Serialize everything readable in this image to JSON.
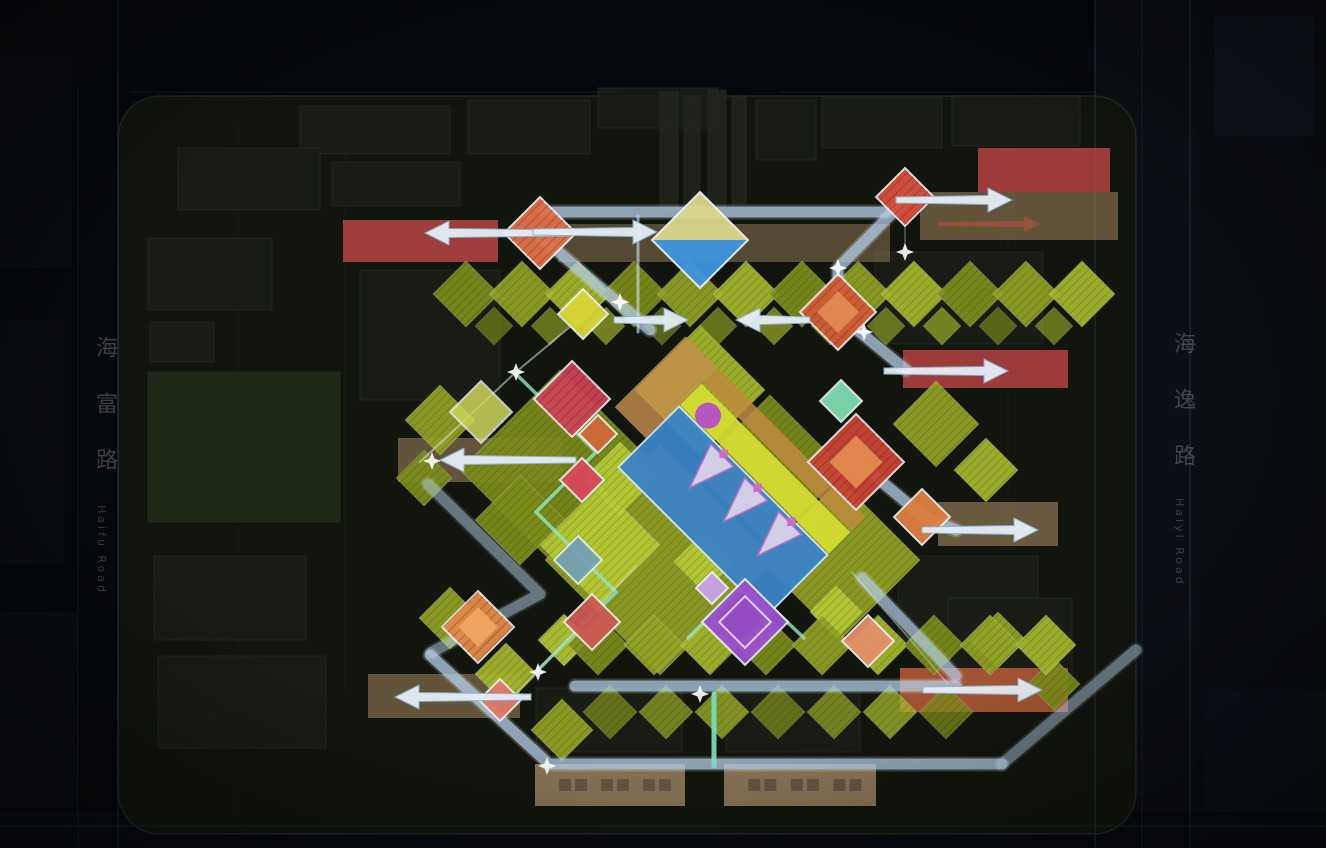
{
  "meta": {
    "title": "residential-masterplan-landscape-axis-analysis",
    "canvas_w": 1326,
    "canvas_h": 848,
    "background": "#05080c"
  },
  "roads": {
    "left": {
      "zh": "海富路",
      "en": "Haifu Road"
    },
    "right": {
      "zh": "海逸路",
      "en": "Haiyi Road"
    }
  },
  "palette": {
    "path_blue": "#aecbe6",
    "path_teal": "#93e4c4",
    "arrow_fill": "#e6eef6",
    "arrow_stroke": "#8fb4d4",
    "site_fill": "#12150e",
    "site_stroke": "#3a4038",
    "olive": [
      "#7d8d1c",
      "#93a325",
      "#a7b92e"
    ],
    "lime": "#b5c934",
    "tan_bar": "#b09468",
    "red_bar": "#c24848",
    "orange_bar": "#c4613c",
    "bottom_bar": "#a8906a",
    "pool_blue": "#3c84c6",
    "purple": "#9a50cc",
    "feature_stroke": "#f2f6f8"
  },
  "base": {
    "site": {
      "x": 118,
      "y": 96,
      "w": 1018,
      "h": 738,
      "rx": 42,
      "fill": "#12150e",
      "stroke": "#3a4038"
    },
    "rects": [
      [
        1095,
        0,
        102,
        848,
        "#0c0f15",
        1,
        0
      ],
      [
        1197,
        0,
        129,
        848,
        "#0b0e13",
        1,
        0
      ],
      [
        1214,
        16,
        100,
        120,
        "#10141c",
        1,
        6
      ],
      [
        1205,
        690,
        121,
        158,
        "#0d1118",
        1,
        6
      ],
      [
        0,
        56,
        72,
        212,
        "#0a0d11",
        1,
        4
      ],
      [
        0,
        320,
        64,
        244,
        "#0a0d11",
        1,
        4
      ],
      [
        0,
        612,
        78,
        196,
        "#0a0d11",
        1,
        4
      ],
      [
        0,
        812,
        1326,
        36,
        "#080b10",
        1,
        0
      ]
    ],
    "lines": [
      [
        118,
        0,
        118,
        848,
        "#232a31",
        2,
        0.5
      ],
      [
        78,
        86,
        78,
        848,
        "#232a31",
        1.5,
        0.35
      ],
      [
        1095,
        0,
        1095,
        848,
        "#262d36",
        2,
        0.55
      ],
      [
        1142,
        0,
        1142,
        848,
        "#1d232c",
        1.5,
        0.5
      ],
      [
        1190,
        0,
        1190,
        848,
        "#262d36",
        2,
        0.5
      ],
      [
        0,
        826,
        1326,
        826,
        "#1d242c",
        2,
        0.5
      ],
      [
        130,
        92,
        620,
        92,
        "#20262c",
        1.5,
        0.4
      ],
      [
        780,
        92,
        1095,
        92,
        "#20262c",
        1.5,
        0.4
      ],
      [
        345,
        130,
        345,
        690,
        "#20261e",
        1,
        0.35
      ],
      [
        1008,
        120,
        1008,
        750,
        "#20261e",
        1,
        0.35
      ],
      [
        238,
        120,
        238,
        812,
        "#20261e",
        1,
        0.3
      ]
    ]
  },
  "buildings": [
    [
      "b",
      300,
      106,
      150,
      48
    ],
    [
      "b",
      468,
      100,
      122,
      54
    ],
    [
      "b",
      822,
      98,
      120,
      50
    ],
    [
      "b",
      952,
      96,
      128,
      50
    ],
    [
      "b",
      178,
      148,
      142,
      62
    ],
    [
      "b",
      332,
      162,
      128,
      44
    ],
    [
      "b",
      148,
      238,
      124,
      72
    ],
    [
      "b",
      150,
      322,
      64,
      40
    ],
    [
      "f",
      148,
      372,
      192,
      150
    ],
    [
      "b",
      154,
      556,
      152,
      84
    ],
    [
      "b",
      158,
      656,
      168,
      92
    ],
    [
      "b",
      875,
      252,
      168,
      92
    ],
    [
      "b",
      898,
      556,
      140,
      84
    ],
    [
      "b",
      536,
      688,
      146,
      64
    ],
    [
      "b",
      726,
      688,
      134,
      64
    ],
    [
      "b",
      948,
      598,
      124,
      84
    ],
    [
      "b",
      360,
      270,
      140,
      130
    ],
    [
      "b",
      598,
      88,
      120,
      40
    ],
    [
      "d",
      660,
      92,
      18,
      118
    ],
    [
      "d",
      684,
      96,
      16,
      112
    ],
    [
      "d",
      708,
      90,
      18,
      116
    ],
    [
      "d",
      732,
      96,
      14,
      108
    ],
    [
      "b",
      756,
      100,
      60,
      60
    ]
  ],
  "greenery": {
    "bands": [
      {
        "y": 294,
        "x1": 466,
        "x2": 1122,
        "step": 56,
        "r": 33,
        "o": 0.92
      },
      {
        "y": 326,
        "x1": 494,
        "x2": 1066,
        "step": 56,
        "r": 19,
        "o": 0.65
      },
      {
        "y": 645,
        "x1": 598,
        "x2": 1046,
        "step": 56,
        "r": 30,
        "o": 0.92
      },
      {
        "y": 712,
        "x1": 610,
        "x2": 950,
        "step": 56,
        "r": 27,
        "o": 0.75
      }
    ],
    "singles": [
      [
        560,
        470,
        100,
        0
      ],
      [
        660,
        560,
        115,
        1
      ],
      [
        770,
        470,
        75,
        0
      ],
      [
        840,
        560,
        80,
        1
      ],
      [
        700,
        390,
        65,
        2
      ],
      [
        520,
        520,
        45,
        0
      ],
      [
        936,
        424,
        43,
        1
      ],
      [
        986,
        470,
        32,
        2
      ],
      [
        440,
        420,
        35,
        1
      ],
      [
        424,
        478,
        28,
        0
      ],
      [
        450,
        618,
        31,
        1
      ],
      [
        506,
        674,
        31,
        2
      ],
      [
        562,
        730,
        31,
        1
      ],
      [
        998,
        640,
        28,
        1
      ],
      [
        1054,
        684,
        26,
        0
      ],
      [
        600,
        545,
        60,
        "L"
      ],
      [
        620,
        478,
        36,
        "L"
      ],
      [
        704,
        562,
        30,
        "L"
      ],
      [
        564,
        640,
        26,
        "L"
      ],
      [
        836,
        612,
        26,
        "L"
      ]
    ]
  },
  "bars": [
    {
      "x": 343,
      "y": 220,
      "w": 155,
      "h": 42,
      "fill": "#c24848",
      "o": 0.8
    },
    {
      "x": 558,
      "y": 224,
      "w": 332,
      "h": 38,
      "fill": "#b09468",
      "o": 0.42
    },
    {
      "x": 920,
      "y": 192,
      "w": 198,
      "h": 48,
      "fill": "#b09468",
      "o": 0.5
    },
    {
      "x": 978,
      "y": 148,
      "w": 132,
      "h": 44,
      "fill": "#c24848",
      "o": 0.78
    },
    {
      "x": 903,
      "y": 350,
      "w": 165,
      "h": 38,
      "fill": "#c24848",
      "o": 0.78
    },
    {
      "x": 938,
      "y": 502,
      "w": 120,
      "h": 44,
      "fill": "#b09468",
      "o": 0.55
    },
    {
      "x": 398,
      "y": 438,
      "w": 164,
      "h": 44,
      "fill": "#b09468",
      "o": 0.5
    },
    {
      "x": 368,
      "y": 674,
      "w": 152,
      "h": 44,
      "fill": "#b09468",
      "o": 0.5
    },
    {
      "x": 900,
      "y": 668,
      "w": 168,
      "h": 44,
      "fill": "#c4613c",
      "o": 0.8
    },
    {
      "x": 535,
      "y": 764,
      "w": 150,
      "h": 42,
      "fill": "#a8906a",
      "o": 0.78,
      "marks": true
    },
    {
      "x": 724,
      "y": 764,
      "w": 152,
      "h": 42,
      "fill": "#a8906a",
      "o": 0.78,
      "marks": true
    }
  ],
  "paths": {
    "wide": [
      {
        "d": "M545,212 H886",
        "o": 0.72
      },
      {
        "d": "M540,236 L650,330",
        "o": 0.7
      },
      {
        "d": "M905,200 L838,268 L838,310",
        "o": 0.7
      },
      {
        "d": "M838,314 L906,370",
        "o": 0.7
      },
      {
        "d": "M858,462 L924,517 L956,530",
        "o": 0.7
      },
      {
        "d": "M575,686 H956",
        "o": 0.7
      },
      {
        "d": "M430,655 L549,764 H1002",
        "o": 0.72
      },
      {
        "d": "M1002,764 L1136,650",
        "o": 0.45
      },
      {
        "d": "M862,578 L956,676",
        "o": 0.65
      },
      {
        "d": "M428,484 L540,594 L432,652",
        "o": 0.45
      }
    ],
    "thin": [
      [
        "M638,216 L638,332",
        "#cfe2f4",
        3,
        0.6
      ],
      [
        "M714,694 L714,766",
        "#7fe0c0",
        5,
        0.9
      ],
      [
        "M516,374 L596,452 L536,512 L616,592 L538,670",
        "#93e4c4",
        3.5,
        0.8
      ],
      [
        "M688,638 L745,582 L804,638",
        "#93e4c4",
        3.5,
        0.8
      ],
      [
        "M420,462 L516,372 L583,316",
        "#e8f4f0",
        2,
        0.5
      ],
      [
        "M512,698 L636,566",
        "#dde8ee",
        1.5,
        0.4
      ],
      [
        "M948,684 L852,572",
        "#dde8ee",
        1.5,
        0.4
      ],
      [
        "M905,225 L905,252",
        "#dde8ee",
        1.5,
        0.35
      ]
    ]
  },
  "features": [
    {
      "cx": 540,
      "cy": 233,
      "r": 36,
      "fill": "#e0714a",
      "hatch": true
    },
    {
      "cx": 905,
      "cy": 197,
      "r": 29,
      "fill": "#d6503f",
      "hatch": true
    },
    {
      "cx": 838,
      "cy": 312,
      "r": 38,
      "fill": "#d05c36",
      "hatch": true,
      "inner": "#e08a52"
    },
    {
      "cx": 856,
      "cy": 462,
      "r": 48,
      "fill": "#c94436",
      "hatch": true,
      "inner": "#e28a50"
    },
    {
      "cx": 572,
      "cy": 399,
      "r": 38,
      "fill": "#c94355",
      "hatch": true
    },
    {
      "cx": 598,
      "cy": 434,
      "r": 19,
      "fill": "#d2693a"
    },
    {
      "cx": 582,
      "cy": 480,
      "r": 22,
      "fill": "#d84858"
    },
    {
      "cx": 478,
      "cy": 627,
      "r": 36,
      "fill": "#e08a4a",
      "hatch": true,
      "inner": "#efa562"
    },
    {
      "cx": 592,
      "cy": 622,
      "r": 28,
      "fill": "#cc5a52"
    },
    {
      "cx": 500,
      "cy": 700,
      "r": 21,
      "fill": "#e0786a"
    },
    {
      "cx": 922,
      "cy": 517,
      "r": 28,
      "fill": "#dd8040"
    },
    {
      "cx": 868,
      "cy": 641,
      "r": 26,
      "fill": "#e2906a"
    },
    {
      "cx": 583,
      "cy": 314,
      "r": 25,
      "fill": "#d8d73a"
    },
    {
      "cx": 481,
      "cy": 412,
      "r": 31,
      "fill": "#ccd65c",
      "o": 0.85
    },
    {
      "cx": 841,
      "cy": 401,
      "r": 21,
      "fill": "#7edcb0"
    },
    {
      "cx": 578,
      "cy": 560,
      "r": 24,
      "fill": "#6f9cc0",
      "o": 0.85
    },
    {
      "cx": 745,
      "cy": 622,
      "r": 43,
      "fill": "#9a50cc",
      "innerStroke": true
    },
    {
      "cx": 712,
      "cy": 588,
      "r": 16,
      "fill": "#c9a3e8"
    }
  ],
  "pool": {
    "cx": 742,
    "cy": 492,
    "rot": 45,
    "deck": "#c79050",
    "strip_orange": "#bf8a40",
    "strip_yellow": "#d4dc34",
    "water": "#3c84c6",
    "water_stroke": "#cfe4f2",
    "blob": "#b44fc8",
    "sail_fill": "#ecdcf0",
    "sail_stroke": "#cf6ac4"
  },
  "entrance": {
    "cx": 700,
    "cy": 240,
    "r": 48,
    "top": "#d9d78c",
    "bottom": "#3f93dd",
    "stroke": "#eef4f8"
  },
  "arrows": [
    [
      425,
      233,
      "left",
      120,
      "std"
    ],
    [
      657,
      232,
      "right",
      100,
      "std"
    ],
    [
      1012,
      200,
      "right",
      92,
      "std"
    ],
    [
      688,
      320,
      "right",
      50,
      "std"
    ],
    [
      736,
      320,
      "left",
      50,
      "std"
    ],
    [
      440,
      460,
      "left",
      112,
      "std"
    ],
    [
      1008,
      371,
      "right",
      100,
      "std"
    ],
    [
      1038,
      530,
      "right",
      92,
      "std"
    ],
    [
      395,
      697,
      "left",
      112,
      "std"
    ],
    [
      1042,
      690,
      "right",
      95,
      "std"
    ],
    [
      1040,
      224,
      "right",
      86,
      "faint-red"
    ]
  ],
  "sparkles": [
    [
      516,
      372
    ],
    [
      620,
      302
    ],
    [
      538,
      672
    ],
    [
      700,
      694
    ],
    [
      864,
      332
    ],
    [
      432,
      461
    ],
    [
      547,
      766
    ],
    [
      838,
      268
    ],
    [
      905,
      252
    ]
  ]
}
